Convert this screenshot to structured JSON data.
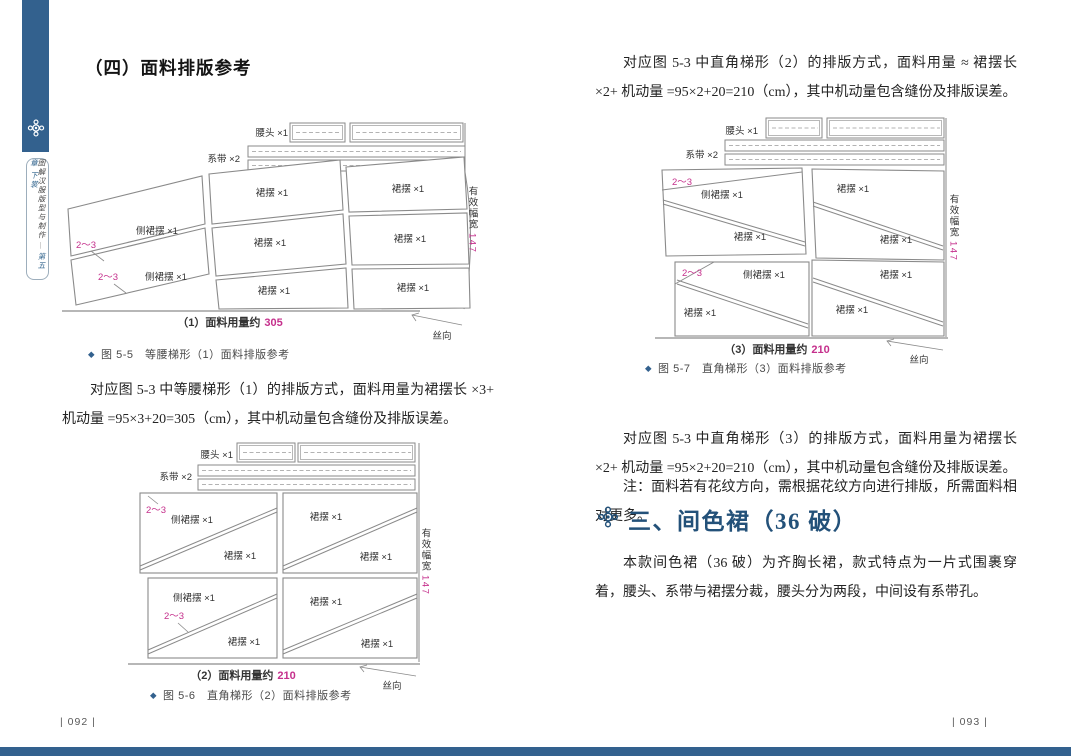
{
  "colors": {
    "accent": "#33618e",
    "section_heading": "#235179",
    "highlight_pink": "#c5308c"
  },
  "spine": {
    "book_title": "图解汉服版型与制作",
    "separator": "—",
    "chapter": "第五章",
    "volume": "下裳"
  },
  "diagram_labels": {
    "marker": "◆",
    "waistband": "腰头 ×1",
    "tie": "系带 ×2",
    "panel": "裙摆 ×1",
    "side_panel": "侧裙摆 ×1",
    "allowance": "2～3",
    "width_label": "有效幅宽",
    "width_value": "147",
    "grain": "丝向"
  },
  "figs": {
    "fig55": {
      "usage_label": "（1）面料用量约",
      "usage_value": "305",
      "caption": "图 5-5　等腰梯形（1）面料排版参考"
    },
    "fig56": {
      "usage_label": "（2）面料用量约",
      "usage_value": "210",
      "caption": "图 5-6　直角梯形（2）面料排版参考"
    },
    "fig57": {
      "usage_label": "（3）面料用量约",
      "usage_value": "210",
      "caption": "图 5-7　直角梯形（3）面料排版参考"
    }
  },
  "left_page": {
    "heading": "（四）面料排版参考",
    "para1": "对应图 5-3 中等腰梯形（1）的排版方式，面料用量为裙摆长 ×3+ 机动量 =95×3+20=305（cm），其中机动量包含缝份及排版误差。",
    "page_number": "| 092 |"
  },
  "right_page": {
    "para1": "对应图 5-3 中直角梯形（2）的排版方式，面料用量 ≈ 裙摆长 ×2+ 机动量 =95×2+20=210（cm），其中机动量包含缝份及排版误差。",
    "para2": "对应图 5-3 中直角梯形（3）的排版方式，面料用量为裙摆长 ×2+ 机动量 =95×2+20=210（cm），其中机动量包含缝份及排版误差。",
    "note": "注：面料若有花纹方向，需根据花纹方向进行排版，所需面料相对更多。",
    "section_heading": "三、间色裙（36 破）",
    "para3": "本款间色裙（36 破）为齐胸长裙，款式特点为一片式围裹穿着，腰头、系带与裙摆分裁，腰头分为两段，中间设有系带孔。",
    "page_number": "| 093 |"
  }
}
